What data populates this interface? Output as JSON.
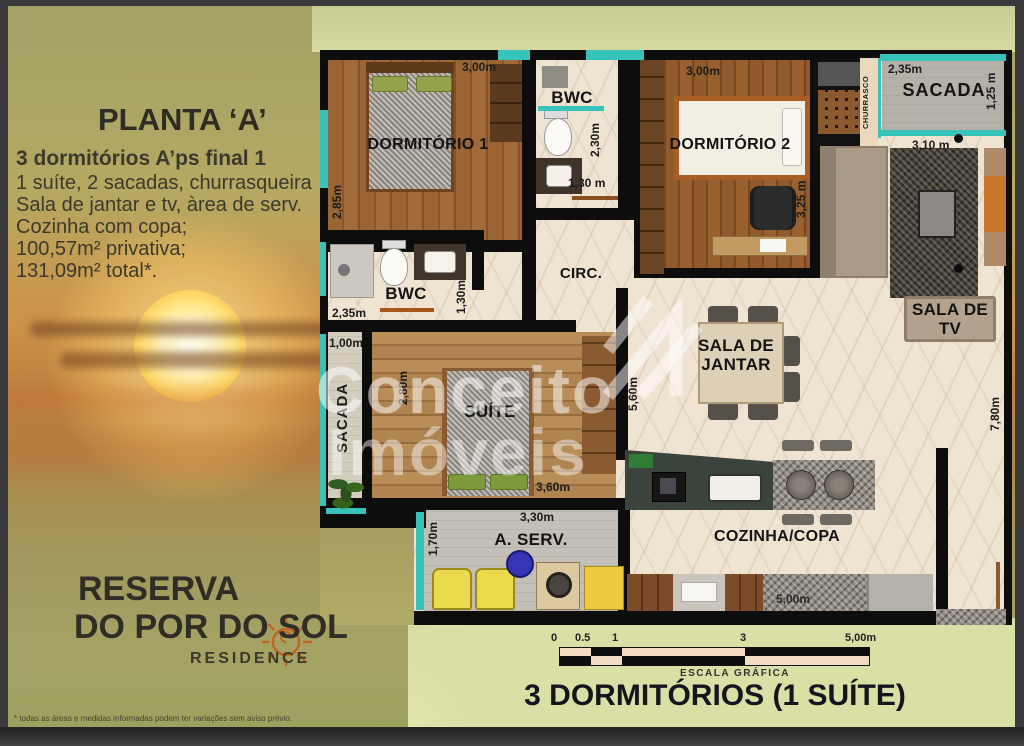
{
  "panel": {
    "title": "PLANTA ‘A’",
    "subtitle": "3 dormitórios A’ps final 1",
    "lines": [
      "1 suíte, 2 sacadas, churrasqueira",
      "Sala de jantar e tv, àrea de serv.",
      "Cozinha com copa;",
      "100,57m² privativa;",
      "131,09m² total*."
    ]
  },
  "branding": {
    "line1": "RESERVA",
    "line2": "DO POR DO SOL",
    "line3": "RESIDENCE"
  },
  "disclaimer": "* todas as áreas e medidas informadas podem ter variações sem aviso prévio.",
  "watermark": {
    "word1": "Conceito",
    "word2": "Imóveis"
  },
  "plan": {
    "rooms": {
      "dorm1": {
        "label": "DORMITÓRIO 1",
        "dim_w": "3,00m",
        "dim_h": "2,85m"
      },
      "bwc1": {
        "label": "BWC",
        "dim_h": "2,30m",
        "dim_w": "1,30 m"
      },
      "dorm2": {
        "label": "DORMITÓRIO 2",
        "dim_w": "3,00m",
        "dim_h": "3,25 m"
      },
      "churrasco": {
        "label": "CHURRASCO"
      },
      "sacada1": {
        "label": "SACADA",
        "dim_w": "2,35m",
        "dim_h": "1,25 m"
      },
      "sala_tv": {
        "label": "SALA DE TV",
        "dim_w": "3,10 m",
        "dim_h": "7,80m"
      },
      "circ": {
        "label": "CIRC."
      },
      "bwc2": {
        "label": "BWC",
        "dim_w": "2,35m",
        "dim_h": "1,30m"
      },
      "sacada2": {
        "label": "SACADA",
        "dim_w": "1,00m"
      },
      "suite": {
        "label": "SUÍTE",
        "dim_h": "2,80m",
        "dim_w": "3,60m"
      },
      "jantar": {
        "label": "SALA DE JANTAR",
        "dim_h": "5,60m"
      },
      "aserv": {
        "label": "A. SERV.",
        "dim_w": "3,30m",
        "dim_h": "1,70m"
      },
      "cozinha": {
        "label": "COZINHA/COPA",
        "dim_w": "5,00m"
      }
    }
  },
  "scale": {
    "ticks": [
      "0",
      "0.5",
      "1",
      "3",
      "5,00m"
    ],
    "caption": "ESCALA GRÁFICA"
  },
  "footer": {
    "title": "3 DORMITÓRIOS (1 SUÍTE)"
  }
}
